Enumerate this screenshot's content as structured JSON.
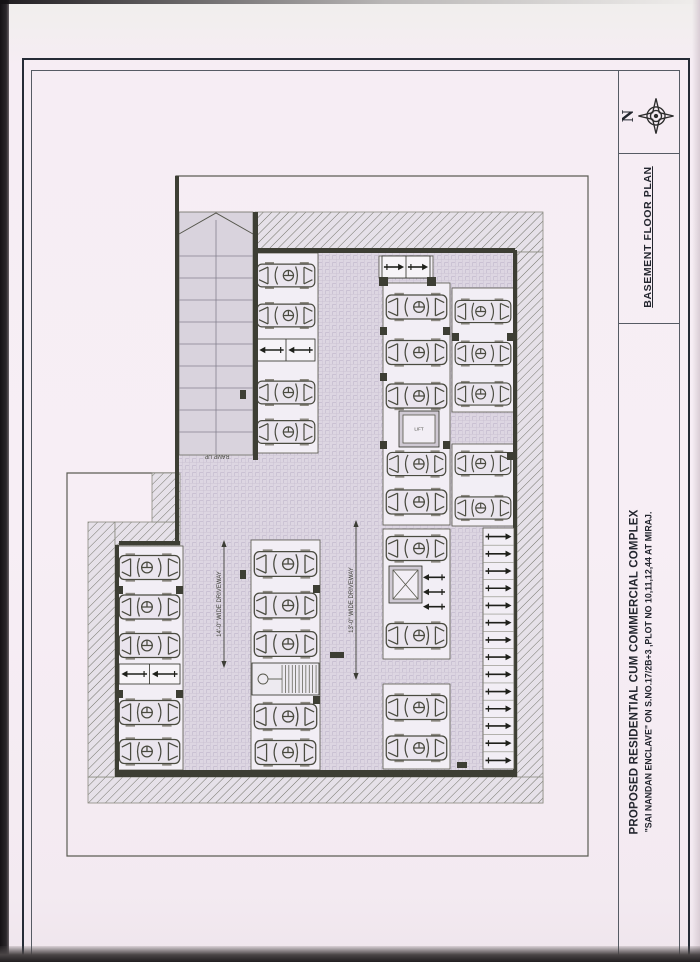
{
  "title_block": {
    "north_label": "N",
    "drawing_title": "BASEMENT FLOOR PLAN",
    "project_line1": "PROPOSED RESIDENTIAL CUM COMMERCIAL COMPLEX",
    "project_line2": "\"SAI NANDAN ENCLAVE\" ON S.NO.17/2B+3 ,PLOT NO 10,11,12,44 AT MIRAJ."
  },
  "colors": {
    "paper": "#f6edf4",
    "wall": "#3d3e34",
    "line": "#4a4b40",
    "pave_bg": "#ddd6e2",
    "pave_line": "#c4bbce",
    "bay_bg": "#f2eef5",
    "ramp_bg": "#d9d3dd",
    "hatch_bg": "#e6e1e9",
    "hatch_line": "#73746a"
  },
  "plan": {
    "labels": {
      "ramp_up": "RAMP UP",
      "driveway_left": "14'-0\" WIDE DRIVEWAY",
      "driveway_right": "13'-0\" WIDE DRIVEWAY",
      "lift": "LIFT"
    },
    "boundary": [
      [
        176,
        176
      ],
      [
        588,
        176
      ],
      [
        588,
        856
      ],
      [
        67,
        856
      ],
      [
        67,
        473
      ],
      [
        176,
        473
      ]
    ],
    "pave_rects": [
      [
        253,
        253,
        264,
        517
      ],
      [
        119,
        545,
        134,
        225
      ],
      [
        179,
        455,
        74,
        90
      ]
    ],
    "hatch_rects": [
      [
        255,
        212,
        288,
        40
      ],
      [
        517,
        252,
        26,
        551
      ],
      [
        88,
        777,
        455,
        26
      ],
      [
        88,
        522,
        27,
        255
      ],
      [
        115,
        522,
        65,
        23
      ],
      [
        152,
        473,
        28,
        49
      ]
    ],
    "walls": [
      [
        175,
        176,
        4,
        369
      ],
      [
        253,
        212,
        5,
        248
      ],
      [
        255,
        248,
        260,
        5
      ],
      [
        513,
        250,
        4,
        527
      ],
      [
        115,
        770,
        402,
        7
      ],
      [
        119,
        541,
        61,
        4
      ],
      [
        115,
        545,
        4,
        225
      ]
    ],
    "stubs": [
      [
        379,
        277,
        9,
        9
      ],
      [
        427,
        277,
        9,
        9
      ],
      [
        380,
        327,
        7,
        8
      ],
      [
        443,
        327,
        7,
        8
      ],
      [
        380,
        373,
        7,
        8
      ],
      [
        380,
        441,
        7,
        8
      ],
      [
        443,
        441,
        7,
        8
      ],
      [
        452,
        333,
        7,
        8
      ],
      [
        507,
        333,
        7,
        8
      ],
      [
        507,
        452,
        7,
        8
      ],
      [
        240,
        390,
        6,
        9
      ],
      [
        240,
        570,
        6,
        9
      ],
      [
        116,
        586,
        7,
        8
      ],
      [
        176,
        586,
        7,
        8
      ],
      [
        116,
        690,
        7,
        8
      ],
      [
        176,
        690,
        7,
        8
      ],
      [
        313,
        585,
        7,
        8
      ],
      [
        313,
        696,
        7,
        8
      ],
      [
        330,
        652,
        14,
        6
      ],
      [
        457,
        762,
        10,
        6
      ]
    ],
    "ramp": {
      "x": 179,
      "y": 212,
      "w": 74,
      "h": 243,
      "chevron": [
        [
          179,
          234
        ],
        [
          216,
          213
        ],
        [
          253,
          234
        ]
      ],
      "treads_from": 256,
      "treads_to": 450,
      "tread_step": 22,
      "center_x": 216,
      "label_x": 217,
      "label_y": 459
    },
    "bays": [
      {
        "x": 254,
        "y": 253,
        "w": 64,
        "h": 200,
        "stalls": [
          {
            "t": "car",
            "y": 258,
            "h": 35,
            "dir": "l"
          },
          {
            "t": "car",
            "y": 298,
            "h": 35,
            "dir": "l"
          },
          {
            "t": "arrows",
            "y": 339,
            "h": 22,
            "dir": "l",
            "n": 2
          },
          {
            "t": "car",
            "y": 375,
            "h": 35,
            "dir": "l"
          },
          {
            "t": "car",
            "y": 415,
            "h": 34,
            "dir": "l"
          }
        ]
      },
      {
        "x": 251,
        "y": 540,
        "w": 69,
        "h": 230,
        "stalls": [
          {
            "t": "car",
            "y": 546,
            "h": 36,
            "dir": "l"
          },
          {
            "t": "car",
            "y": 588,
            "h": 35,
            "dir": "l"
          },
          {
            "t": "car",
            "y": 627,
            "h": 34,
            "dir": "l"
          },
          {
            "t": "stair",
            "y": 663,
            "h": 32
          },
          {
            "t": "car",
            "y": 700,
            "h": 33,
            "dir": "l"
          },
          {
            "t": "car",
            "y": 737,
            "h": 31,
            "dir": "l"
          }
        ]
      },
      {
        "x": 116,
        "y": 546,
        "w": 67,
        "h": 224,
        "stalls": [
          {
            "t": "car",
            "y": 551,
            "h": 33,
            "dir": "r"
          },
          {
            "t": "car",
            "y": 590,
            "h": 34,
            "dir": "r"
          },
          {
            "t": "car",
            "y": 629,
            "h": 33,
            "dir": "r"
          },
          {
            "t": "arrows",
            "y": 664,
            "h": 20,
            "dir": "l",
            "n": 2
          },
          {
            "t": "car",
            "y": 696,
            "h": 33,
            "dir": "r"
          },
          {
            "t": "car",
            "y": 735,
            "h": 33,
            "dir": "r"
          }
        ]
      },
      {
        "x": 383,
        "y": 283,
        "w": 67,
        "h": 242,
        "stalls": [
          {
            "t": "car",
            "y": 288,
            "h": 38,
            "dir": "l"
          },
          {
            "t": "car",
            "y": 334,
            "h": 37,
            "dir": "l"
          },
          {
            "t": "car",
            "y": 379,
            "h": 34,
            "dir": "l"
          },
          {
            "t": "car",
            "y": 449,
            "h": 30,
            "dir": "l"
          },
          {
            "t": "car",
            "y": 484,
            "h": 36,
            "dir": "l"
          }
        ]
      },
      {
        "x": 383,
        "y": 529,
        "w": 67,
        "h": 130,
        "stalls": [
          {
            "t": "car",
            "y": 531,
            "h": 35,
            "dir": "l"
          },
          {
            "t": "arrowstack",
            "y": 570,
            "h": 44,
            "dir": "l",
            "n": 3
          },
          {
            "t": "car",
            "y": 616,
            "h": 39,
            "dir": "l"
          }
        ]
      },
      {
        "x": 383,
        "y": 684,
        "w": 67,
        "h": 85,
        "stalls": [
          {
            "t": "car",
            "y": 688,
            "h": 39,
            "dir": "l"
          },
          {
            "t": "car",
            "y": 729,
            "h": 38,
            "dir": "l"
          }
        ]
      },
      {
        "x": 452,
        "y": 288,
        "w": 62,
        "h": 124,
        "stalls": [
          {
            "t": "car",
            "y": 293,
            "h": 37,
            "dir": "r"
          },
          {
            "t": "car",
            "y": 336,
            "h": 35,
            "dir": "r"
          },
          {
            "t": "car",
            "y": 377,
            "h": 34,
            "dir": "r"
          }
        ]
      },
      {
        "x": 452,
        "y": 444,
        "w": 62,
        "h": 82,
        "stalls": [
          {
            "t": "car",
            "y": 448,
            "h": 31,
            "dir": "r"
          },
          {
            "t": "car",
            "y": 492,
            "h": 32,
            "dir": "r"
          }
        ]
      },
      {
        "x": 379,
        "y": 256,
        "w": 54,
        "h": 22,
        "stalls": [
          {
            "t": "arrows",
            "y": 256,
            "h": 22,
            "dir": "r",
            "n": 2
          }
        ]
      }
    ],
    "lifts": [
      {
        "x": 399,
        "y": 411,
        "w": 40,
        "h": 36,
        "style": "lift"
      },
      {
        "x": 389,
        "y": 566,
        "w": 33,
        "h": 37,
        "style": "xshaft"
      }
    ],
    "two_wheeler": {
      "x": 483,
      "y": 528,
      "w": 31,
      "h": 241,
      "count": 14,
      "dir": "r"
    },
    "driveway_labels": [
      {
        "x": 224,
        "y1": 540,
        "y2": 668,
        "key": "driveway_left"
      },
      {
        "x": 356,
        "y1": 520,
        "y2": 680,
        "key": "driveway_right"
      }
    ]
  }
}
